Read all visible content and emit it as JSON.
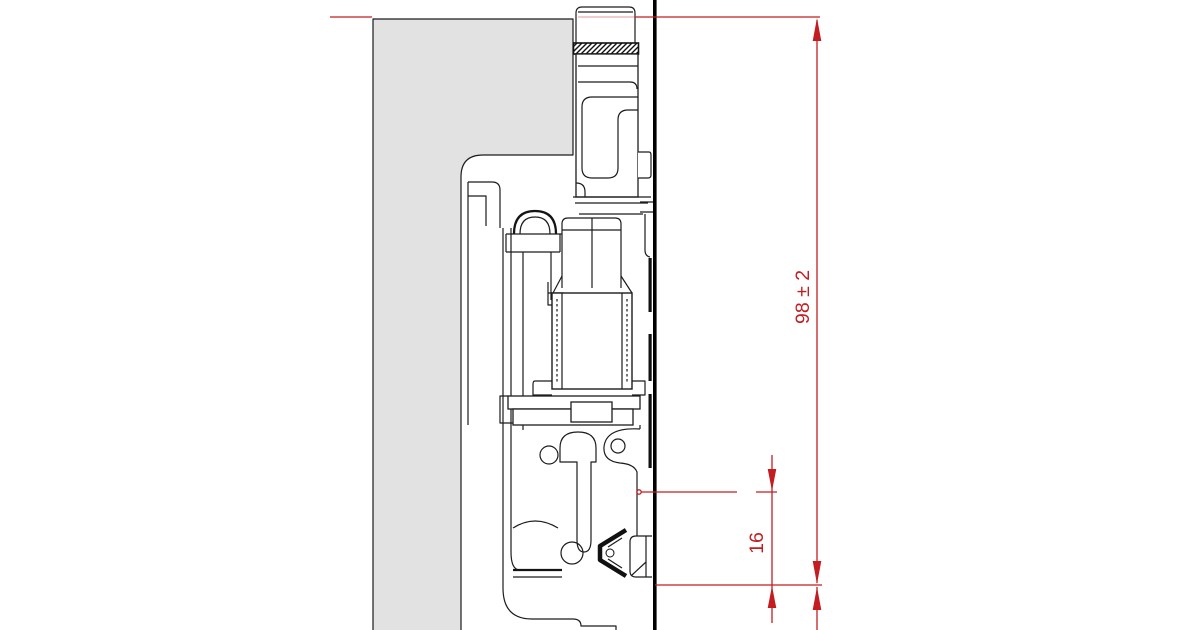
{
  "drawing": {
    "kind": "technical-cross-section",
    "subject": "cabinet side panel with concealed drawer-slide fitting, section view",
    "colors": {
      "dimension_red": "#c41d21",
      "panel_fill": "#e2e2e2",
      "outline": "#1c1c1c",
      "wall_black": "#000000"
    },
    "dimensions": {
      "overall": {
        "label": "98 ± 2",
        "orientation": "vertical"
      },
      "offset": {
        "label": "16",
        "orientation": "vertical"
      }
    }
  }
}
